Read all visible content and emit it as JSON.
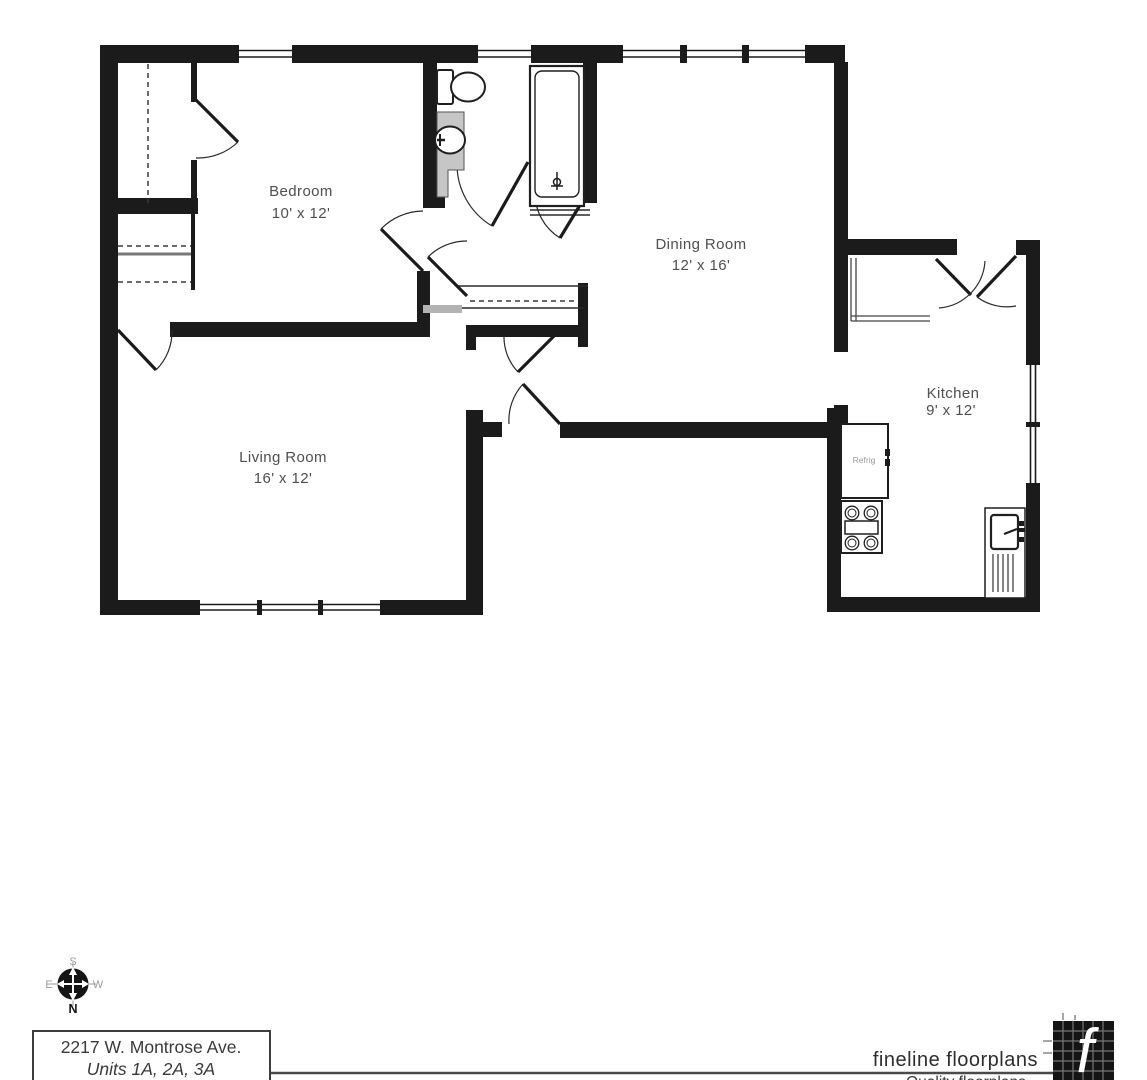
{
  "plan": {
    "rooms": [
      {
        "label": "Bedroom",
        "dims": "10' x 12'"
      },
      {
        "label": "Dining Room",
        "dims": "12' x 16'"
      },
      {
        "label": "Living Room",
        "dims": "16' x 12'"
      },
      {
        "label": "Kitchen",
        "dims": "9' x 12'"
      }
    ],
    "appliance_labels": {
      "refrigerator": "Refrig"
    }
  },
  "compass": {
    "n": "N",
    "s": "S",
    "e": "E",
    "w": "W"
  },
  "footer": {
    "address_line1": "2217 W. Montrose Ave.",
    "address_line2": "Units 1A, 2A, 3A",
    "logo_text": "fineline floorplans",
    "logo_letter": "f",
    "tagline_clipped": "Quality floorplans"
  },
  "colors": {
    "wall": "#1b1b1b",
    "label_gray": "#4f4f4f",
    "vanity_gray": "#c6c6c6",
    "background": "#ffffff"
  }
}
